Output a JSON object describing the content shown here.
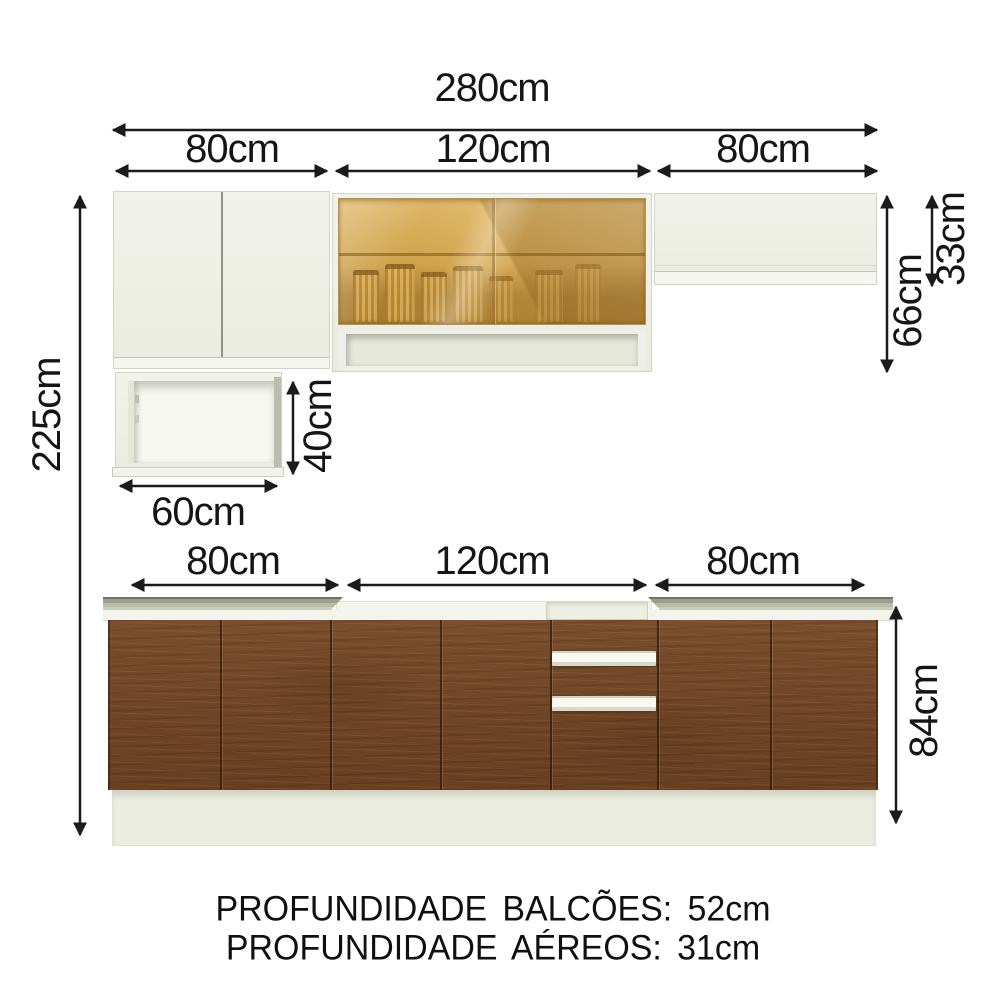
{
  "dims": {
    "total_width": "280cm",
    "upper_section_left": "80cm",
    "upper_section_mid": "120cm",
    "upper_section_right": "80cm",
    "total_height": "225cm",
    "upper_right_total_height": "66cm",
    "upper_right_flap_height": "33cm",
    "open_shelf_height": "40cm",
    "open_shelf_width": "60cm",
    "base_section_left": "80cm",
    "base_section_mid": "120cm",
    "base_section_right": "80cm",
    "base_height": "84cm"
  },
  "footer": {
    "line1": "PROFUNDIDADE BALCÕES: 52cm",
    "line2": "PROFUNDIDADE AÉREOS: 31cm"
  },
  "colors": {
    "arrow": "#1b1b1b",
    "cabinet_white": "#eef0e6",
    "glass_amber": "#cfa047",
    "wood_brown": "#74492a",
    "countertop_gray": "#9aa08c",
    "plinth_white": "#ebede0",
    "background": "#ffffff"
  }
}
